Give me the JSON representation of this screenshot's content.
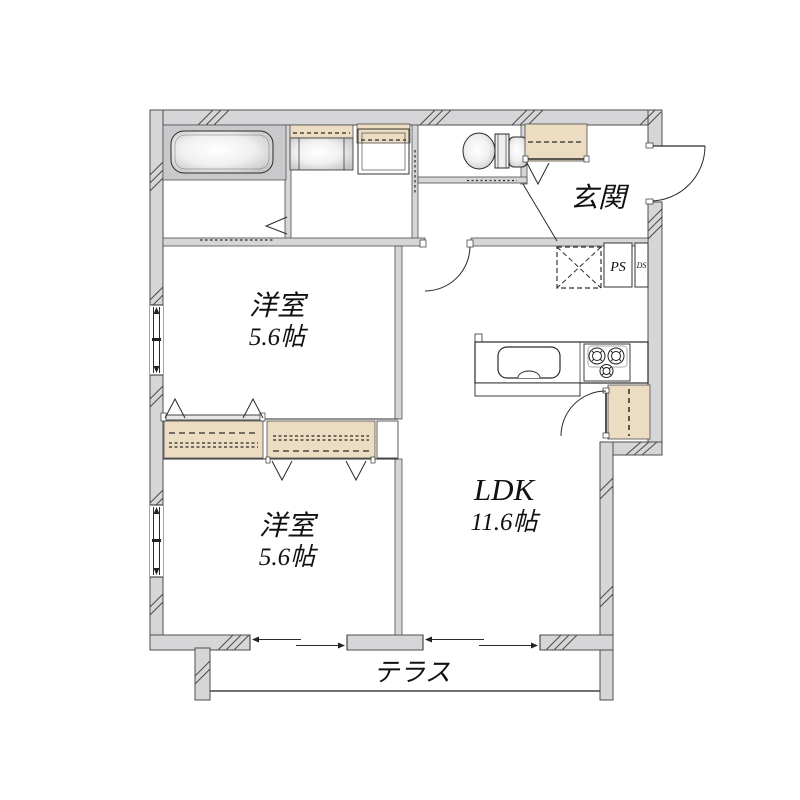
{
  "floorplan": {
    "type": "apartment-floor-plan",
    "rooms": [
      {
        "id": "entrance",
        "label": "玄関"
      },
      {
        "id": "western-room-upper",
        "label": "洋室",
        "size": "5.6帖"
      },
      {
        "id": "western-room-lower",
        "label": "洋室",
        "size": "5.6帖"
      },
      {
        "id": "ldk",
        "label": "LDK",
        "size": "11.6帖"
      },
      {
        "id": "terrace",
        "label": "テラス"
      },
      {
        "id": "pipe-space",
        "label": "PS"
      },
      {
        "id": "duct-space",
        "label": "DS"
      }
    ],
    "labels": {
      "entrance": "玄関",
      "room1_name": "洋室",
      "room1_size": "5.6帖",
      "room2_name": "洋室",
      "room2_size": "5.6帖",
      "ldk_name": "LDK",
      "ldk_size": "11.6帖",
      "terrace": "テラス",
      "ps": "PS",
      "ds": "DS"
    },
    "colors": {
      "wall_fill": "#d6d6d8",
      "fixture_gray": "#c9c9cb",
      "closet_tan": "#ebdcc2",
      "line": "#333333",
      "background": "#ffffff"
    }
  }
}
